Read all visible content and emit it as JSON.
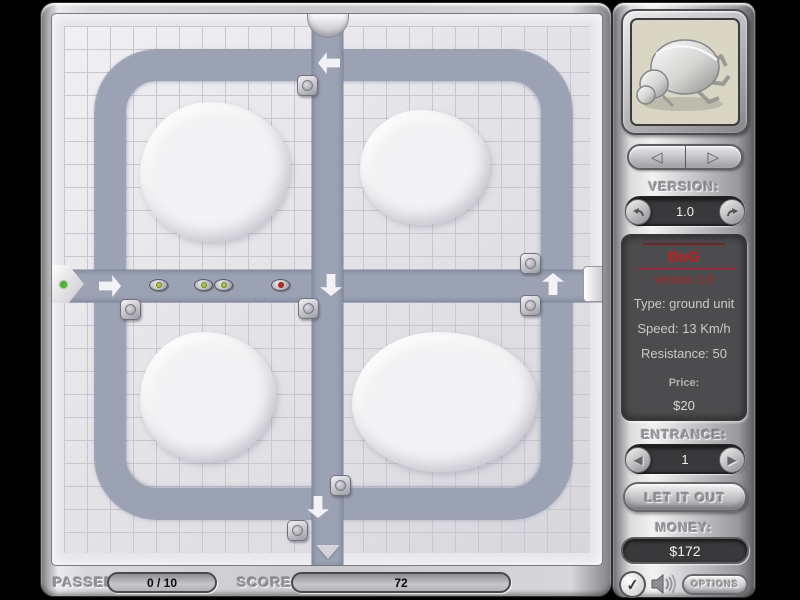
{
  "colors": {
    "path": "#9aa2b3",
    "accent_red": "#c41f1f",
    "bug_dot_green": "#a9c832",
    "bug_dot_red": "#cc2222",
    "entrance_dot_green": "#4db52e"
  },
  "sidebar": {
    "version_label": "VERSION:",
    "version_value": "1.0",
    "unit_info": {
      "name": "BuG",
      "version_line": "version 1.0",
      "type_line": "Type: ground unit",
      "speed_line": "Speed: 13 Km/h",
      "resistance_line": "Resistance: 50",
      "price_label": "Price:",
      "price_value": "$20"
    },
    "entrance_label": "ENTRANCE:",
    "entrance_value": "1",
    "release_button_label": "LET IT OUT",
    "money_label": "MONEY:",
    "money_value": "$172",
    "options_button_label": "OPTIONS"
  },
  "status_bar": {
    "passed_label": "PASSED",
    "passed_value": "0 / 10",
    "score_label": "SCORE",
    "score_value": "72"
  },
  "icons": {
    "prev_unit_glyph": "◁",
    "next_unit_glyph": "▷",
    "entrance_prev_glyph": "◀",
    "entrance_next_glyph": "▶",
    "confirm_glyph": "✓"
  },
  "board": {
    "bugs": [
      {
        "x": 106,
        "y": 271,
        "dot": "#a9c832"
      },
      {
        "x": 151,
        "y": 271,
        "dot": "#a9c832"
      },
      {
        "x": 171,
        "y": 271,
        "dot": "#a9c832"
      },
      {
        "x": 228,
        "y": 271,
        "dot": "#cc2222"
      }
    ],
    "turrets": [
      {
        "x": 255,
        "y": 71
      },
      {
        "x": 78,
        "y": 295
      },
      {
        "x": 256,
        "y": 294
      },
      {
        "x": 478,
        "y": 249
      },
      {
        "x": 478,
        "y": 291
      },
      {
        "x": 288,
        "y": 471
      },
      {
        "x": 245,
        "y": 516
      }
    ],
    "arrows": [
      {
        "x": 58,
        "y": 272,
        "dir": "right"
      },
      {
        "x": 279,
        "y": 271,
        "dir": "down"
      },
      {
        "x": 501,
        "y": 270,
        "dir": "up"
      },
      {
        "x": 277,
        "y": 49,
        "dir": "left"
      },
      {
        "x": 266,
        "y": 493,
        "dir": "down"
      }
    ],
    "mounds": [
      {
        "x": 88,
        "y": 88,
        "w": 150,
        "h": 140
      },
      {
        "x": 308,
        "y": 96,
        "w": 130,
        "h": 115
      },
      {
        "x": 88,
        "y": 318,
        "w": 136,
        "h": 130
      },
      {
        "x": 300,
        "y": 318,
        "w": 185,
        "h": 140
      }
    ]
  }
}
